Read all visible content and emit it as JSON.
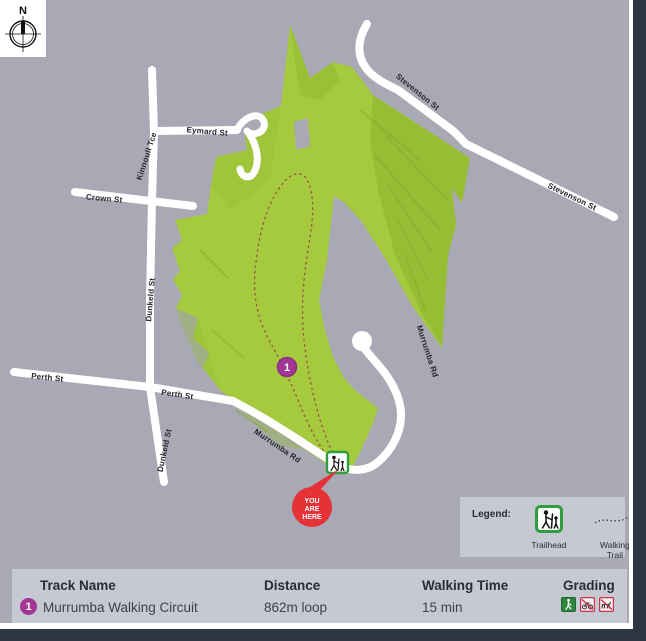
{
  "map": {
    "compass_label": "N",
    "streets": {
      "kinnoull": "Kinnoull Tce",
      "eymard": "Eymard St",
      "crown": "Crown St",
      "dunkeld": "Dunkeld St",
      "perth": "Perth St",
      "murrumba": "Murrumba Rd",
      "stevenson": "Stevenson St"
    },
    "park_name_shown": "",
    "markers": {
      "trail_number": "1",
      "you_are_here": [
        "YOU",
        "ARE",
        "HERE"
      ],
      "trailhead_icon": "trailhead-icon"
    }
  },
  "legend": {
    "title": "Legend:",
    "items": [
      {
        "icon": "trailhead-icon",
        "label": "Trailhead"
      },
      {
        "icon": "walking-trail-icon",
        "label": "Walking Trail"
      }
    ]
  },
  "table": {
    "headers": [
      "Track Name",
      "Distance",
      "Walking Time",
      "Grading"
    ],
    "rows": [
      {
        "number": "1",
        "name": "Murrumba Walking Circuit",
        "distance": "862m loop",
        "walking_time": "15 min",
        "grading_icons": [
          "walker-icon",
          "no-bikes-icon",
          "no-dogs-icon"
        ]
      }
    ]
  },
  "colors": {
    "map_background": "#a8a9b4",
    "park_green": "#a5ca3e",
    "park_shade_green": "#93b932",
    "road": "#ffffff",
    "trail_dotted": "#98544a",
    "marker_purple": "#a23795",
    "you_are_here_red": "#e63137",
    "trailhead_green": "#2f9e41",
    "frame_navy": "#2d3642",
    "panel_gray": "#c6c9d2"
  }
}
